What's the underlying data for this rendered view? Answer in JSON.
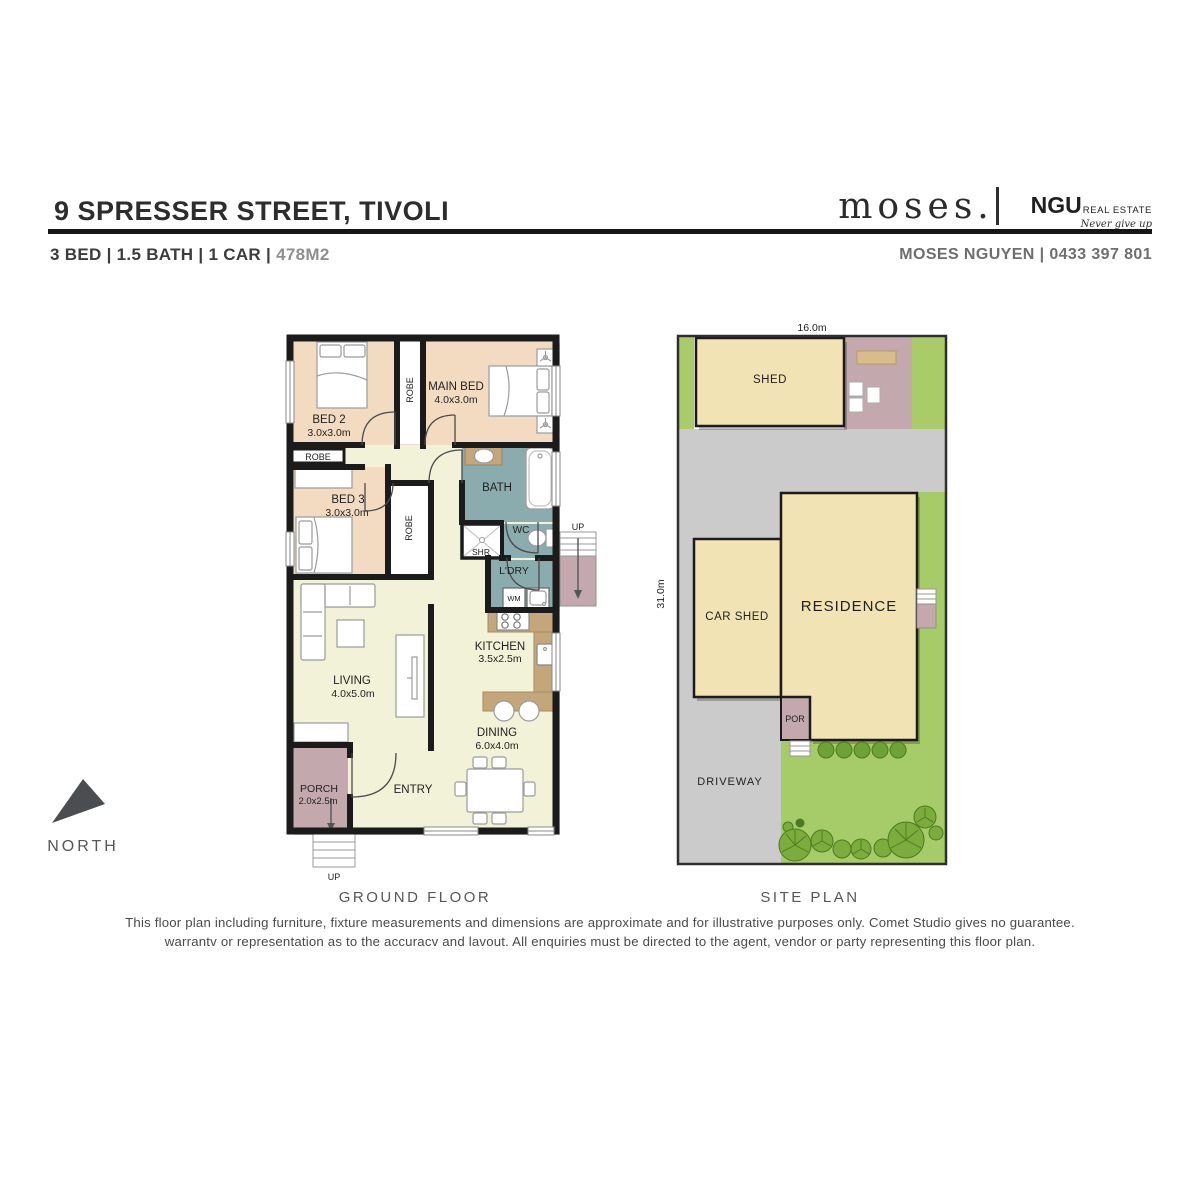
{
  "header": {
    "address": "9 SPRESSER STREET, TIVOLI",
    "specs": "3 BED | 1.5 BATH | 1 CAR |",
    "area": "478M2",
    "brand": "moses.",
    "ngu": "NGU",
    "ngu_suffix": "REAL ESTATE",
    "ngu_tagline": "Never give up",
    "agent": "MOSES NGUYEN | 0433 397 801"
  },
  "floor_plan": {
    "caption": "GROUND FLOOR",
    "bed2": {
      "name": "BED 2",
      "dims": "3.0x3.0m"
    },
    "bed3": {
      "name": "BED 3",
      "dims": "3.0x3.0m"
    },
    "main_bed": {
      "name": "MAIN BED",
      "dims": "4.0x3.0m"
    },
    "living": {
      "name": "LIVING",
      "dims": "4.0x5.0m"
    },
    "dining": {
      "name": "DINING",
      "dims": "6.0x4.0m"
    },
    "kitchen": {
      "name": "KITCHEN",
      "dims": "3.5x2.5m"
    },
    "porch": {
      "name": "PORCH",
      "dims": "2.0x2.5m"
    },
    "bath": "BATH",
    "wc": "WC",
    "shower": "SHR",
    "laundry": "L'DRY",
    "washing_machine": "WM",
    "robe": "ROBE",
    "entry": "ENTRY",
    "up": "UP"
  },
  "site_plan": {
    "caption": "SITE PLAN",
    "width_dim": "16.0m",
    "depth_dim": "31.0m",
    "shed": "SHED",
    "car_shed": "CAR SHED",
    "residence": "RESIDENCE",
    "porch": "POR",
    "driveway": "DRIVEWAY"
  },
  "compass": {
    "label": "NORTH"
  },
  "disclaimer": {
    "line1": "This floor plan including furniture, fixture measurements and dimensions are approximate and for illustrative purposes only. Comet Studio gives no guarantee.",
    "line2": "warrantv or representation as to the accuracv and lavout. All enquiries must be directed to the agent, vendor or party representing this floor plan."
  },
  "colors": {
    "wall": "#1b1b1b",
    "bedroom_peach": "#f3dbc2",
    "living_cream": "#f1f2d8",
    "wet_area_teal": "#8bacae",
    "mauve": "#c3a9ae",
    "counter_brown": "#c4a67b",
    "lawn_green": "#a5cc69",
    "concrete_gray": "#cbcbcb",
    "building_tan": "#f2e3b4",
    "tree_green": "#7cab3e",
    "caption_gray": "#55585a"
  }
}
